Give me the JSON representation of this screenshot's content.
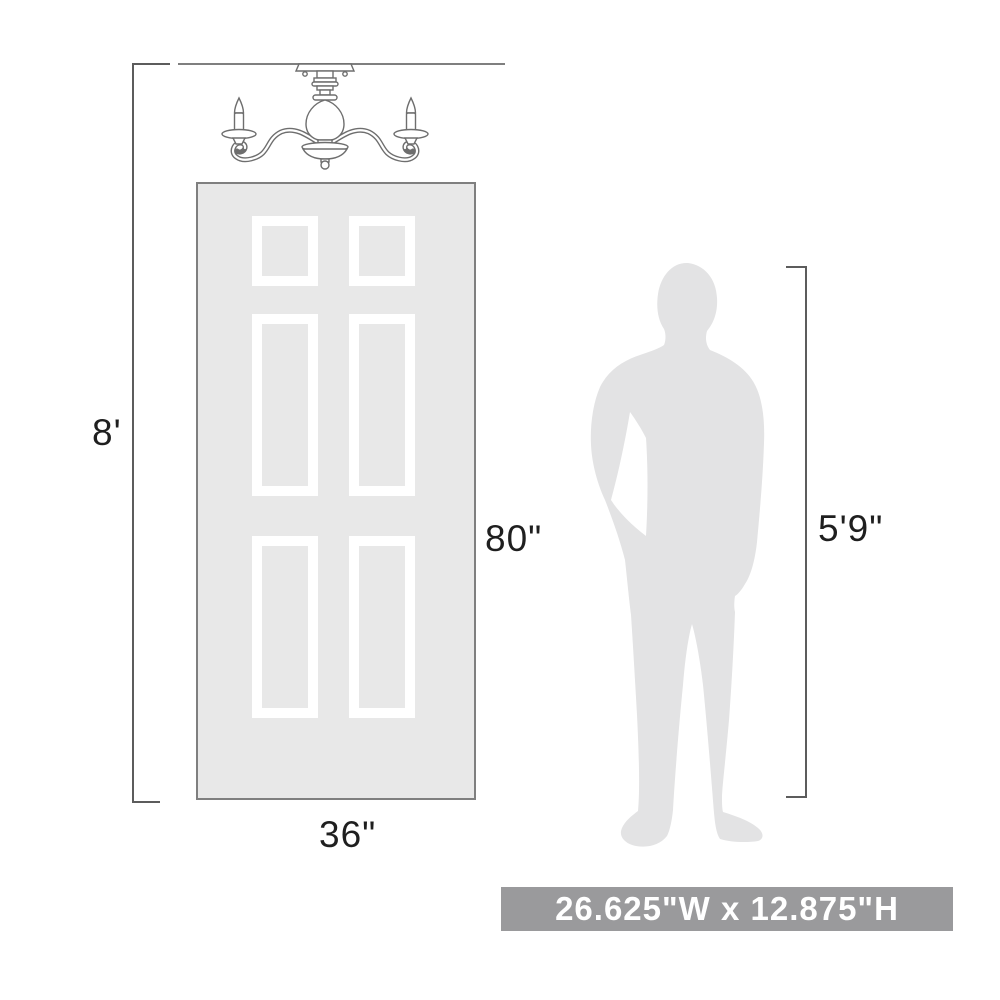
{
  "dimensions": {
    "ceiling_height": "8'",
    "door_height": "80\"",
    "door_width": "36\"",
    "person_height": "5'9\""
  },
  "banner": {
    "text": "26.625\"W x 12.875\"H"
  },
  "colors": {
    "background": "#ffffff",
    "door_fill": "#e8e8e8",
    "door_border": "#7f7f7f",
    "panel_frame": "#ffffff",
    "silhouette": "#e3e3e4",
    "dimension_line": "#5c5c5c",
    "ceiling_line": "#7f7f7f",
    "fixture_stroke": "#6e6e6e",
    "label_text": "#1f1f1f",
    "banner_bg": "#9a9a9c",
    "banner_text": "#ffffff"
  },
  "illustrations": {
    "fixture": "two-arm-candle-semi-flush-light",
    "door": "six-panel-door",
    "person": "standing-man-silhouette"
  }
}
